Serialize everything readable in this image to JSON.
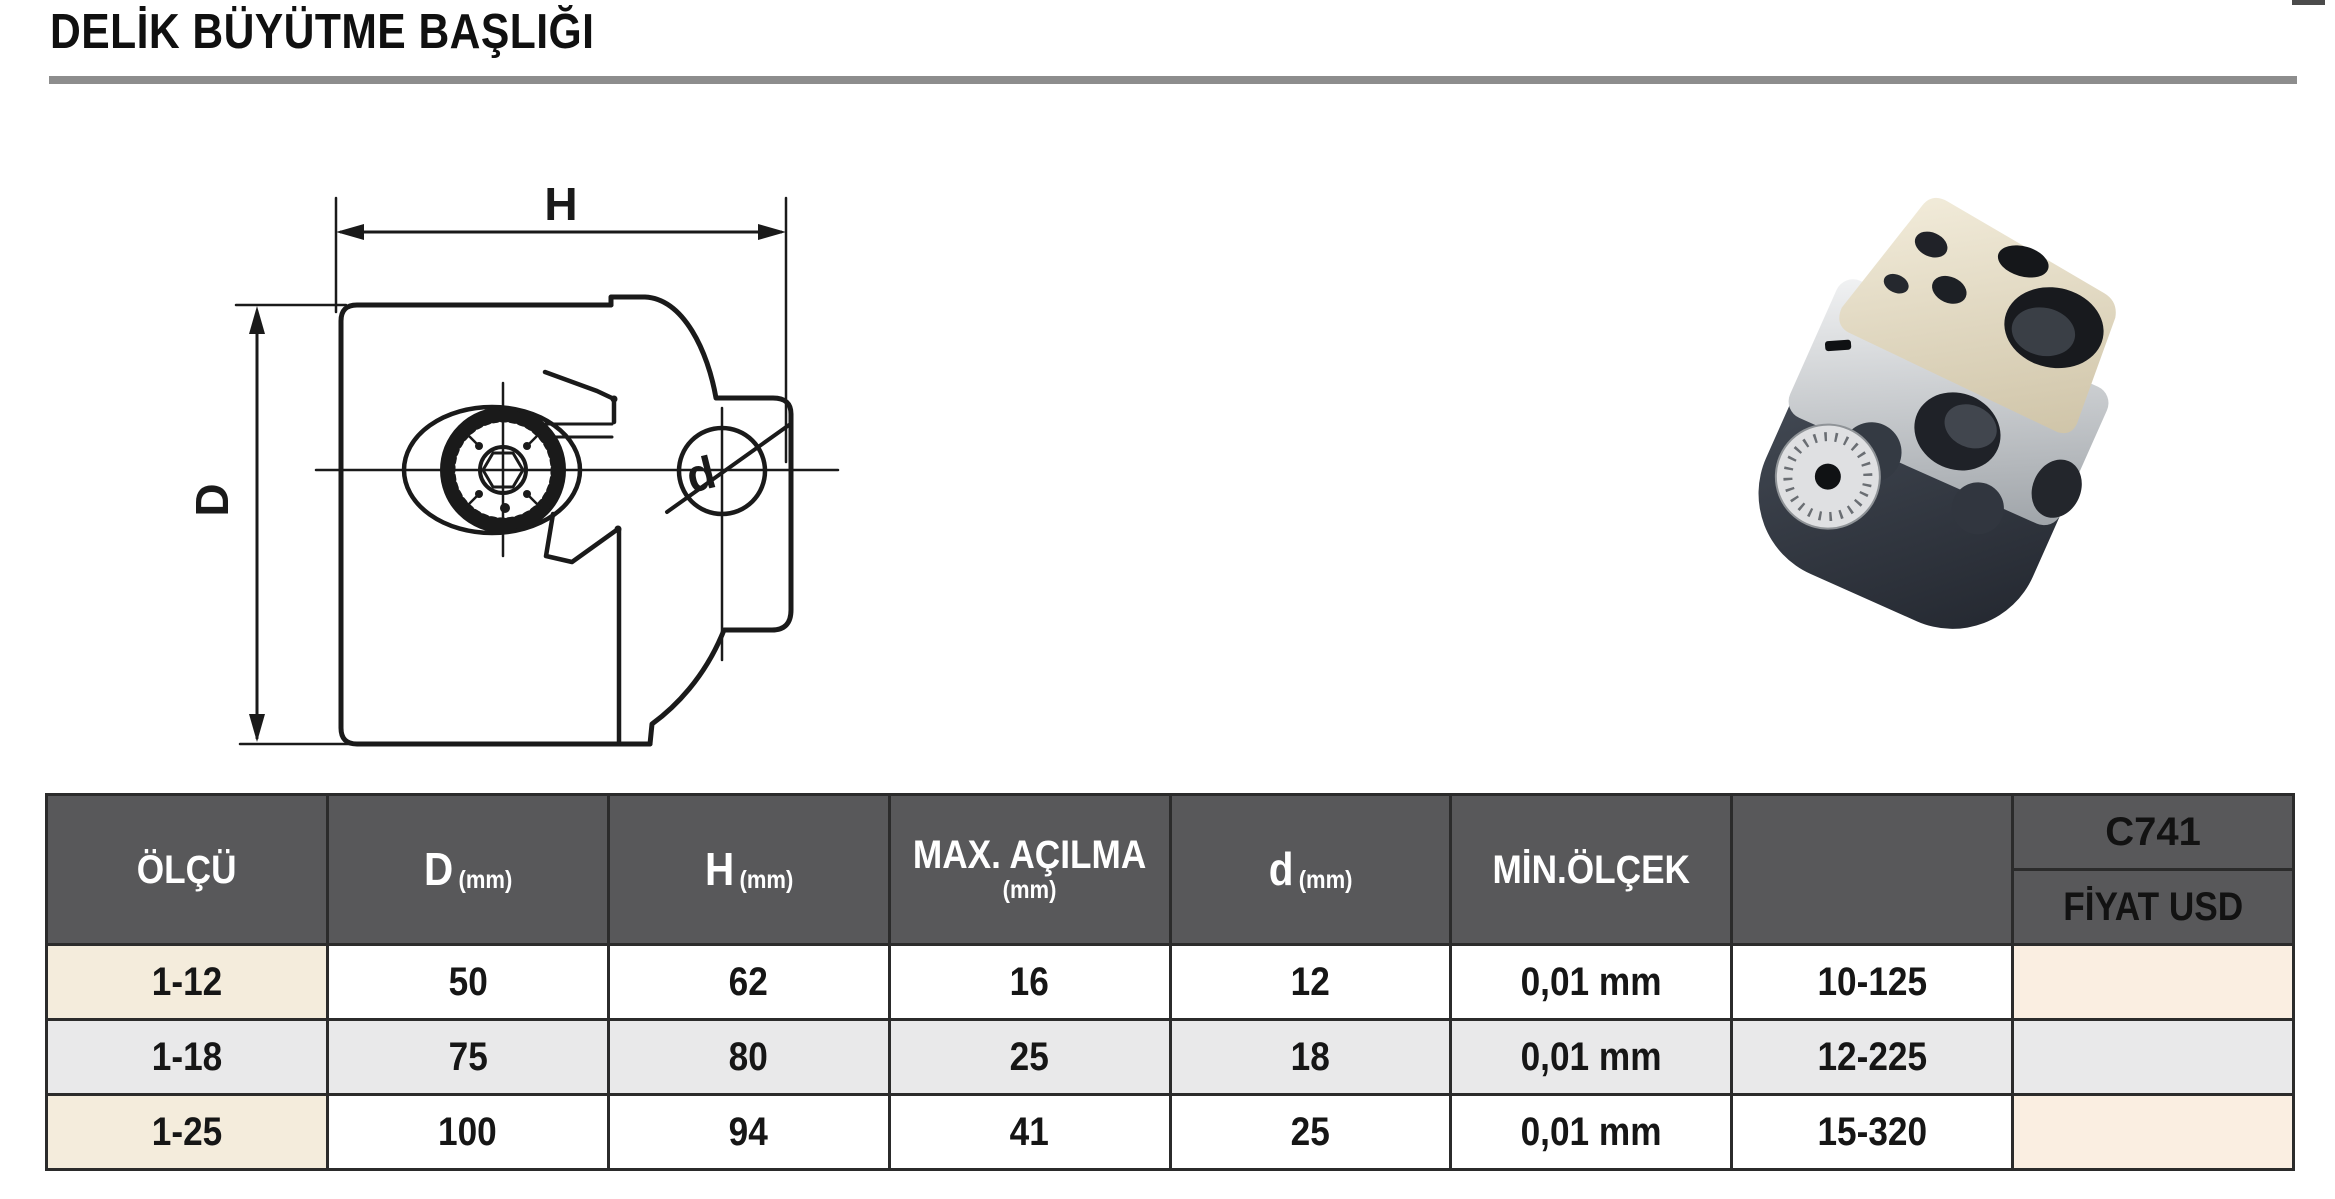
{
  "title": "DELİK BÜYÜTME BAŞLIĞI",
  "drawing": {
    "dim_h": "H",
    "dim_d_outer": "D",
    "dim_d_bore": "d"
  },
  "table": {
    "header": {
      "olcu": "ÖLÇÜ",
      "d_outer": "D",
      "h": "H",
      "max_acilma": "MAX. AÇILMA",
      "d_bore": "d",
      "mm": "(mm)",
      "min_olcek": "MİN.ÖLÇEK",
      "empty": "",
      "code": "C741",
      "price": "FİYAT USD"
    },
    "rows": [
      {
        "size": "1-12",
        "d_outer": "50",
        "h": "62",
        "max": "16",
        "d_bore": "12",
        "min": "0,01 mm",
        "range": "10-125",
        "price": ""
      },
      {
        "size": "1-18",
        "d_outer": "75",
        "h": "80",
        "max": "25",
        "d_bore": "18",
        "min": "0,01 mm",
        "range": "12-225",
        "price": ""
      },
      {
        "size": "1-25",
        "d_outer": "100",
        "h": "94",
        "max": "41",
        "d_bore": "25",
        "min": "0,01 mm",
        "range": "15-320",
        "price": ""
      }
    ]
  },
  "colors": {
    "header_bg": "#58585a",
    "row_alt": "#e9e9ea",
    "size_col_bg": "#f4ecdc",
    "price_col_bg": "#faeee1",
    "border": "#2b2b2b",
    "title_rule": "#8d8d8d"
  }
}
